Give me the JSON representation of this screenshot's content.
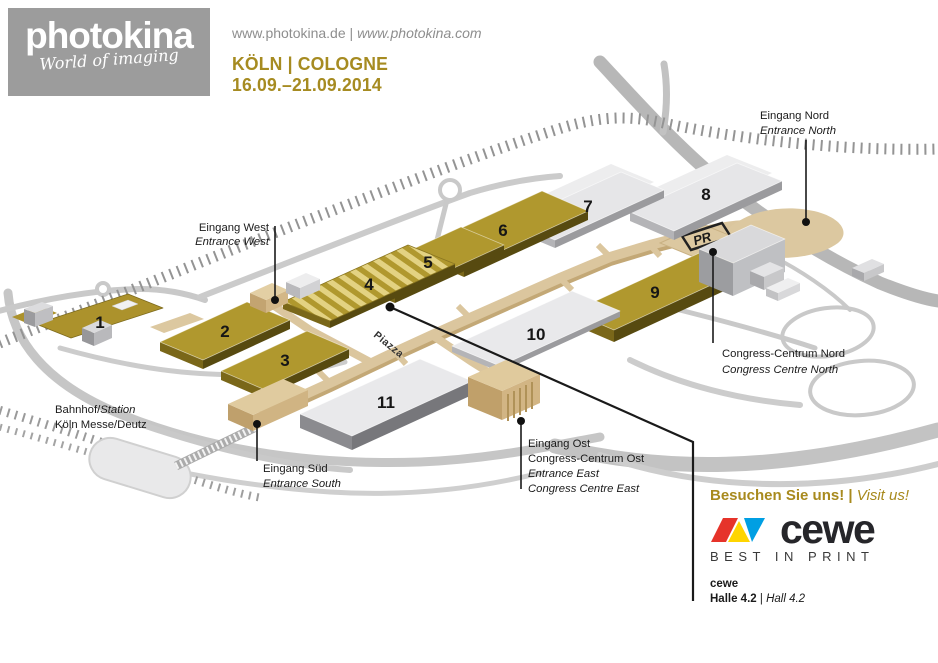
{
  "header": {
    "brand": "photokina",
    "brand_tagline": "World of imaging",
    "website_de": "www.photokina.de",
    "separator": "|",
    "website_int": "www.photokina.com",
    "location": "KÖLN | COLOGNE",
    "dates": "16.09.–21.09.2014"
  },
  "map": {
    "piazza_label": "Piazza",
    "parking_label": "PR",
    "halls": [
      {
        "number": "1"
      },
      {
        "number": "2"
      },
      {
        "number": "3"
      },
      {
        "number": "4"
      },
      {
        "number": "5"
      },
      {
        "number": "6"
      },
      {
        "number": "7"
      },
      {
        "number": "8"
      },
      {
        "number": "9"
      },
      {
        "number": "10"
      },
      {
        "number": "11"
      }
    ],
    "labels": {
      "entrance_west_de": "Eingang West",
      "entrance_west_en": "Entrance West",
      "entrance_north_de": "Eingang Nord",
      "entrance_north_en": "Entrance North",
      "entrance_south_de": "Eingang Süd",
      "entrance_south_en": "Entrance South",
      "entrance_east_l1": "Eingang Ost",
      "entrance_east_l2": "Congress-Centrum Ost",
      "entrance_east_l3": "Entrance East",
      "entrance_east_l4": "Congress Centre East",
      "congress_north_de": "Congress-Centrum Nord",
      "congress_north_en": "Congress Centre North",
      "station_l1a": "Bahnhof/",
      "station_l1b": "Station",
      "station_l2": "Köln Messe/Deutz"
    },
    "colors": {
      "hall_gold": "#b0982e",
      "hall_gray": "#e6e6e8",
      "walkway": "#dbc69e",
      "accent_gold": "#a68b21"
    }
  },
  "promo": {
    "visit_de": "Besuchen Sie uns!",
    "separator": "|",
    "visit_en": "Visit us!",
    "brand": "cewe",
    "tagline": "BEST IN PRINT",
    "exhibitor": "cewe",
    "hall_de": "Halle 4.2",
    "hall_separator": "|",
    "hall_en": "Hall 4.2"
  }
}
